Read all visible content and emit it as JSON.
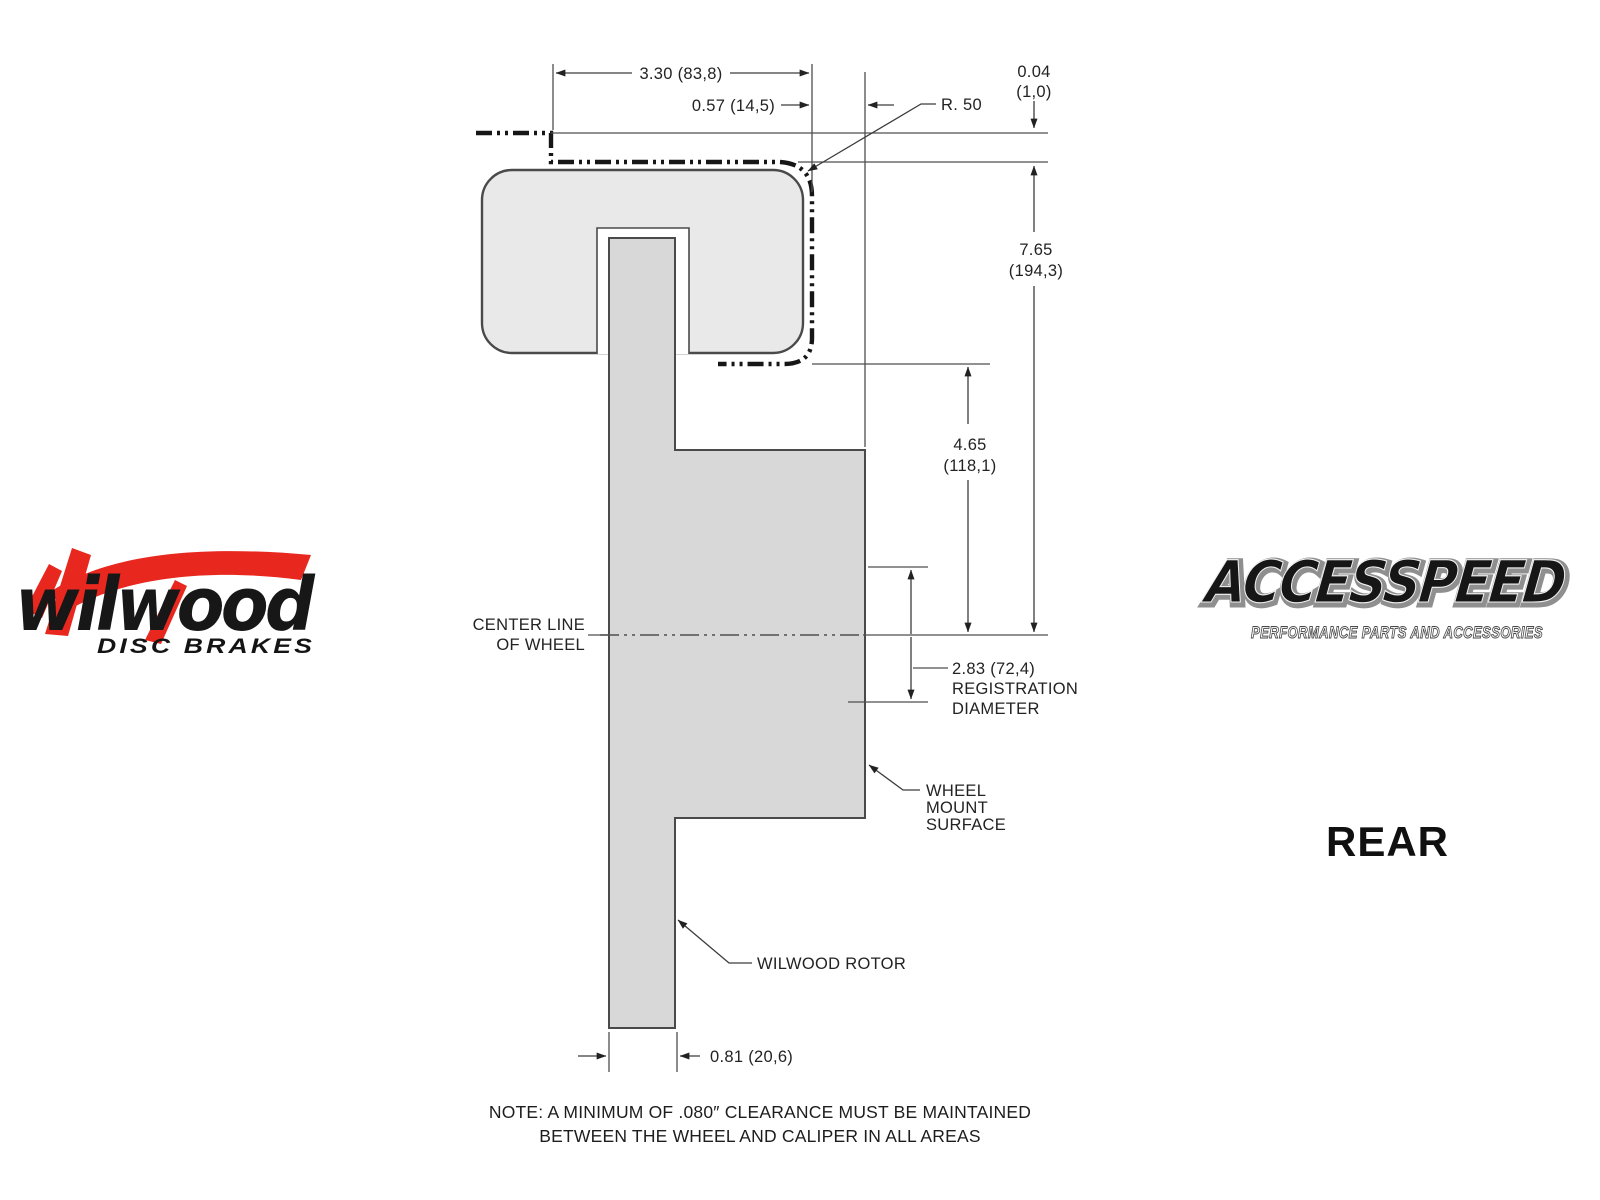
{
  "colors": {
    "background": "#ffffff",
    "accent_red": "#e8281e",
    "drawing_line": "#3c3c3c",
    "phantom_line": "#161616",
    "caliper_fill": "#e9e9e9",
    "rotor_fill": "#d8d8d8",
    "text": "#232323"
  },
  "wilwood_logo": {
    "brand": "wilwood",
    "tagline": "DISC BRAKES"
  },
  "accesspeed_logo": {
    "brand": "ACCESSPEED",
    "tagline": "PERFORMANCE PARTS AND ACCESSORIES"
  },
  "view_label": "REAR",
  "dims": {
    "overall_width": "3.30 (83,8)",
    "mount_to_face": "0.57 (14,5)",
    "corner_radius": "R. 50",
    "top_clearance_in": "0.04",
    "top_clearance_mm": "(1,0)",
    "wheel_radius_in": "7.65",
    "wheel_radius_mm": "(194,3)",
    "mount_radius_in": "4.65",
    "mount_radius_mm": "(118,1)",
    "registration_value": "2.83 (72,4)",
    "registration_word1": "REGISTRATION",
    "registration_word2": "DIAMETER",
    "rotor_thickness": "0.81 (20,6)"
  },
  "labels": {
    "centerline1": "CENTER LINE",
    "centerline2": "OF WHEEL",
    "wheel_mount1": "WHEEL",
    "wheel_mount2": "MOUNT",
    "wheel_mount3": "SURFACE",
    "rotor_callout": "WILWOOD ROTOR"
  },
  "note": {
    "line1": "NOTE: A MINIMUM OF .080″ CLEARANCE MUST BE MAINTAINED",
    "line2": "BETWEEN THE WHEEL AND CALIPER IN ALL AREAS"
  }
}
